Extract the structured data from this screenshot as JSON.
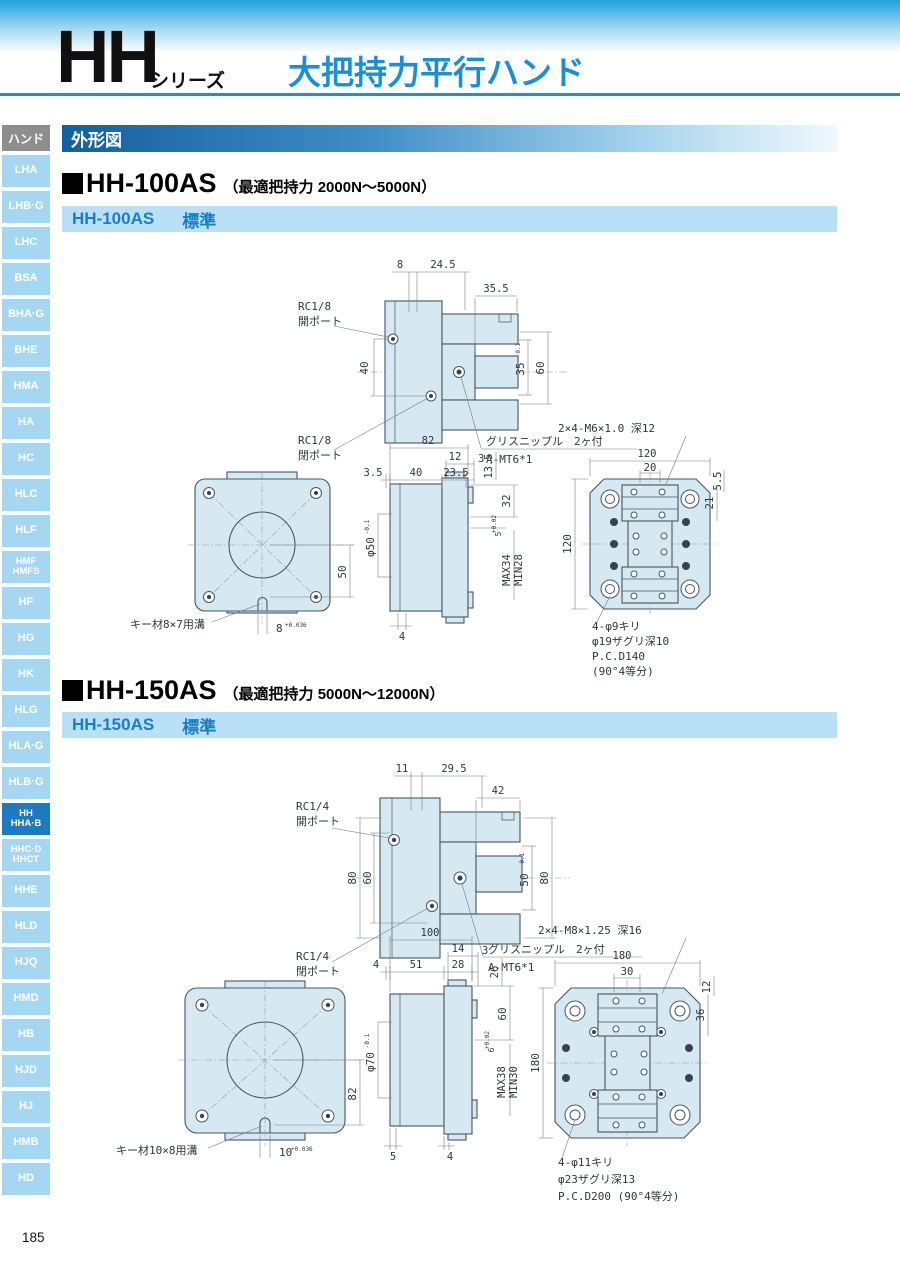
{
  "header": {
    "series": "HH",
    "series_suffix": "シリーズ",
    "title": "大把持力平行ハンド"
  },
  "section": {
    "title": "外形図"
  },
  "page": {
    "number": "185"
  },
  "colors": {
    "accent_blue": "#1e8fd5",
    "sidebar_tab": "#a6d7f2",
    "sidebar_active": "#1c7ac0",
    "bar_bg": "#b9e0f7",
    "drawing_fill": "#d6e9f3"
  },
  "sidebar": {
    "header": "ハンド",
    "items": [
      {
        "l1": "LHA"
      },
      {
        "l1": "LHB·G"
      },
      {
        "l1": "LHC"
      },
      {
        "l1": "BSA"
      },
      {
        "l1": "BHA·G"
      },
      {
        "l1": "BHE"
      },
      {
        "l1": "HMA"
      },
      {
        "l1": "HA"
      },
      {
        "l1": "HC"
      },
      {
        "l1": "HLC"
      },
      {
        "l1": "HLF"
      },
      {
        "l1": "HMF",
        "l2": "HMFS"
      },
      {
        "l1": "HF"
      },
      {
        "l1": "HG"
      },
      {
        "l1": "HK"
      },
      {
        "l1": "HLG"
      },
      {
        "l1": "HLA·G"
      },
      {
        "l1": "HLB·G"
      },
      {
        "l1": "HH",
        "l2": "HHA·B",
        "active": true
      },
      {
        "l1": "HHC·D",
        "l2": "HHCT"
      },
      {
        "l1": "HHE"
      },
      {
        "l1": "HLD"
      },
      {
        "l1": "HJQ"
      },
      {
        "l1": "HMD"
      },
      {
        "l1": "HB"
      },
      {
        "l1": "HJD"
      },
      {
        "l1": "HJ"
      },
      {
        "l1": "HMB"
      },
      {
        "l1": "HD"
      }
    ]
  },
  "products": [
    {
      "heading": "HH-100AS",
      "note": "（最適把持力 2000N〜5000N）",
      "bar_model": "HH-100AS",
      "bar_type": "標準",
      "side": {
        "d8": "8",
        "d245": "24.5",
        "d355": "35.5",
        "open1": "RC1/8",
        "open2": "開ポート",
        "close1": "RC1/8",
        "close2": "閉ポート",
        "d40": "40",
        "d35": "35",
        "d35tol": "-0.1",
        "d60": "60",
        "grease": "グリスニップル　2ヶ付",
        "nipple": "A-MT6*1"
      },
      "flange": {
        "key": "キー材8×7用溝",
        "kw": "8",
        "kwtol": "+0.036",
        "d50": "50"
      },
      "elev": {
        "d82": "82",
        "d12": "12",
        "d3": "3",
        "d35": "3.5",
        "d40": "40",
        "d235": "23.5",
        "d135": "13.5",
        "d32": "32",
        "d5": "5",
        "d5tol": "+0.02",
        "dphi": "φ50",
        "dphitol": "-0.1",
        "dmax": "MAX34",
        "dmin": "MIN28",
        "d4": "4"
      },
      "face": {
        "tap": "2×4-M6×1.0 深12",
        "d120": "120",
        "d20": "20",
        "d55": "5.5",
        "d21": "21",
        "d120v": "120",
        "h1": "4-φ9キリ",
        "h2": "φ19ザグリ深10",
        "h3": "P.C.D140",
        "h4": "(90°4等分)"
      }
    },
    {
      "heading": "HH-150AS",
      "note": "（最適把持力 5000N〜12000N）",
      "bar_model": "HH-150AS",
      "bar_type": "標準",
      "side": {
        "d11": "11",
        "d295": "29.5",
        "d42": "42",
        "open1": "RC1/4",
        "open2": "開ポート",
        "close1": "RC1/4",
        "close2": "閉ポート",
        "d80l": "80",
        "d60": "60",
        "d50": "50",
        "d50tol": "-0.1",
        "d80r": "80",
        "grease": "グリスニップル　2ヶ付",
        "nipple": "A-MT6*1"
      },
      "flange": {
        "key": "キー材10×8用溝",
        "kw": "10",
        "kwtol": "+0.036",
        "d82": "82"
      },
      "elev": {
        "d100": "100",
        "d14": "14",
        "d3": "3",
        "d4": "4",
        "d51": "51",
        "d28": "28",
        "d26": "26",
        "d60": "60",
        "d6": "6",
        "d6tol": "+0.02",
        "dphi": "φ70",
        "dphitol": "-0.1",
        "dmax": "MAX38",
        "dmin": "MIN30",
        "d5": "5",
        "d4b": "4"
      },
      "face": {
        "tap": "2×4-M8×1.25 深16",
        "d180": "180",
        "d30": "30",
        "d12": "12",
        "d36": "36",
        "d180v": "180",
        "h1": "4-φ11キリ",
        "h2": "φ23ザグリ深13",
        "h3": "P.C.D200 (90°4等分)"
      }
    }
  ]
}
